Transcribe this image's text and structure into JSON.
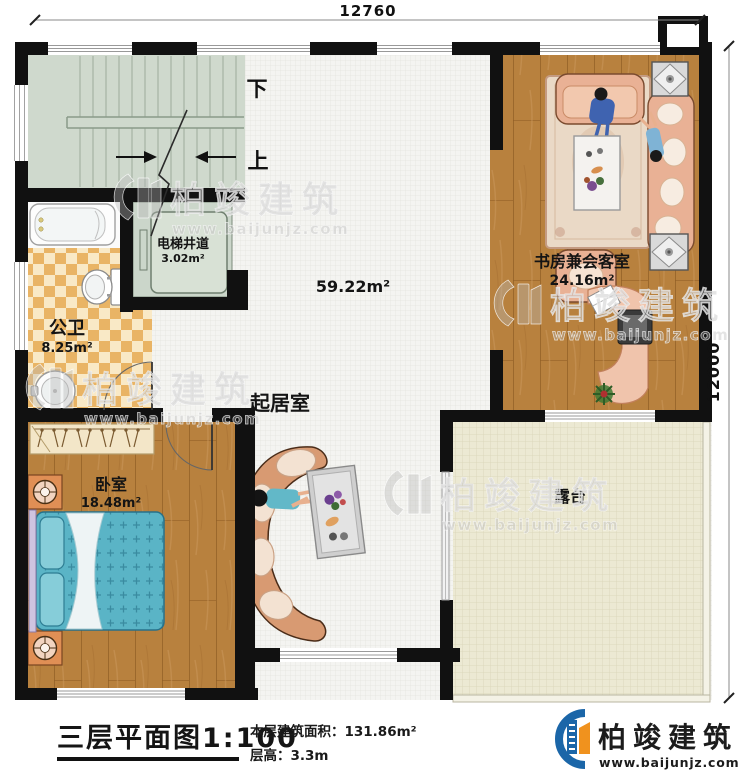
{
  "dimensions": {
    "top": "12760",
    "right": "12000"
  },
  "plan": {
    "stair_down": "下",
    "stair_up": "上",
    "rooms": {
      "elevator": {
        "name": "电梯井道",
        "area": "3.02m²"
      },
      "bathroom": {
        "name": "公卫",
        "area": "8.25m²"
      },
      "living": {
        "name": "起居室",
        "area": "59.22m²"
      },
      "study": {
        "name": "书房兼会客室",
        "area": "24.16m²"
      },
      "bedroom": {
        "name": "卧室",
        "area": "18.48m²"
      },
      "terrace": {
        "name": "露台"
      }
    }
  },
  "watermark": {
    "name": "柏竣建筑",
    "website": "www.baijunjz.com"
  },
  "title_block": {
    "title": "三层平面图",
    "scale": "1:100",
    "stats": [
      {
        "label": "本层建筑面积：",
        "value": "131.86m²"
      },
      {
        "label": "层高：",
        "value": "3.3m"
      }
    ]
  },
  "brand": {
    "name": "柏竣建筑",
    "website": "www.baijunjz.com"
  },
  "colors": {
    "wall": "#111111",
    "wood_floor": "#b8813e",
    "stair_floor": "#cfd9cd",
    "bathroom_tile": "#e9b465",
    "terrace_floor": "#ece9d3",
    "bed": "#5ab4c6",
    "sofa": "#d89a72",
    "logo_blue": "#1b66a8",
    "logo_orange": "#f0921e"
  }
}
